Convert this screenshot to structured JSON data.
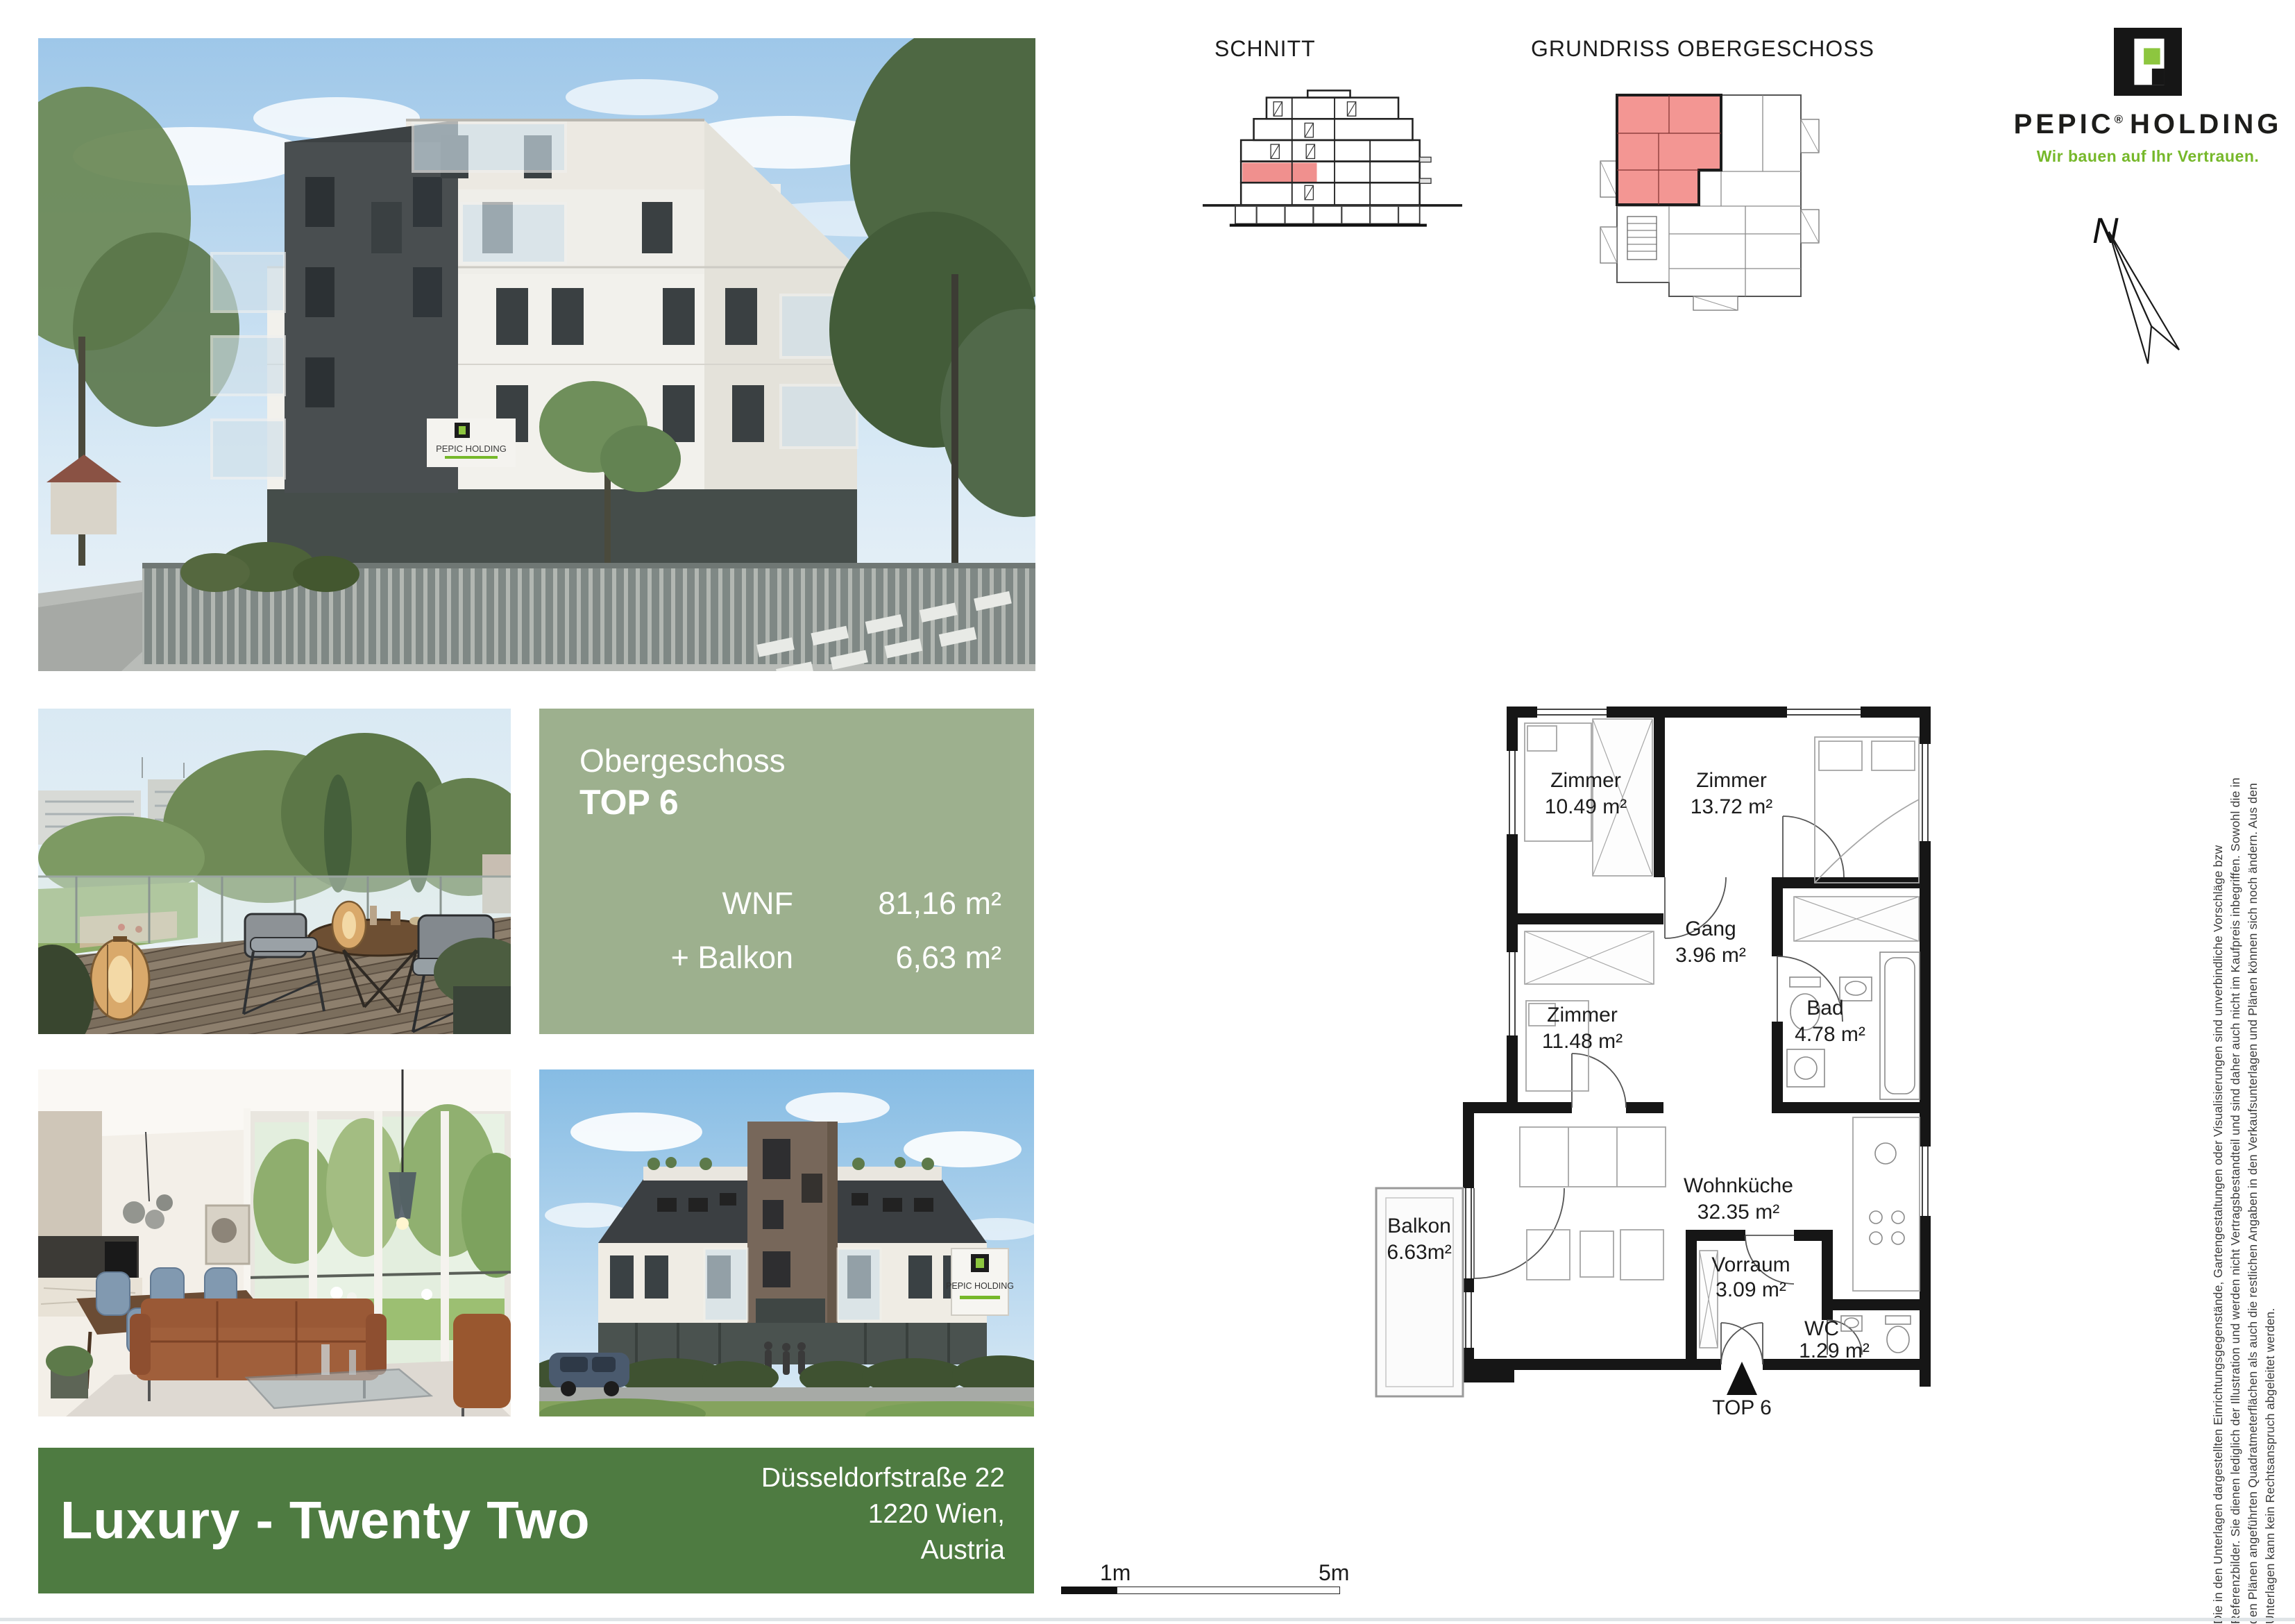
{
  "header": {
    "schnitt_label": "SCHNITT",
    "grundriss_label": "GRUNDRISS OBERGESCHOSS"
  },
  "logo": {
    "brand1": "PEPIC",
    "reg": "®",
    "brand2": "HOLDING",
    "tagline": "Wir bauen auf Ihr Vertrauen.",
    "accent_green": "#8dc63f",
    "tagline_green": "#76b82a"
  },
  "north": {
    "label": "N"
  },
  "info_box": {
    "floor": "Obergeschoss",
    "unit": "TOP 6",
    "metrics": [
      {
        "label": "WNF",
        "value": "81,16 m²"
      },
      {
        "label": "+ Balkon",
        "value": "6,63 m²"
      }
    ],
    "bg": "#9db08e"
  },
  "floor_plan": {
    "rooms": [
      {
        "name": "Zimmer",
        "area": "10.49 m²"
      },
      {
        "name": "Zimmer",
        "area": "13.72 m²"
      },
      {
        "name": "Gang",
        "area": "3.96 m²"
      },
      {
        "name": "Zimmer",
        "area": "11.48 m²"
      },
      {
        "name": "Bad",
        "area": "4.78 m²"
      },
      {
        "name": "Balkon",
        "area": "6.63m²"
      },
      {
        "name": "Wohnküche",
        "area": "32.35 m²"
      },
      {
        "name": "Vorraum",
        "area": "3.09 m²"
      },
      {
        "name": "WC",
        "area": "1.29 m²"
      }
    ],
    "entrance_label": "TOP 6",
    "highlight_color": "#f0908e"
  },
  "scale_bar": {
    "tick1": "1m",
    "tick2": "5m"
  },
  "footer": {
    "title": "Luxury - Twenty Two",
    "address_line1": "Düsseldorfstraße 22",
    "address_line2": "1220 Wien,",
    "address_line3": "Austria",
    "bg": "#4e7b41"
  },
  "photos": {
    "sign_text": "PEPIC HOLDING"
  },
  "disclaimer": {
    "lines": [
      "Die in den Unterlagen dargestellten Einrichtungsgegenstände, Gartengestaltungen oder Visualisierungen sind unverbindliche Vorschläge bzw",
      "Referenzbilder. Sie dienen lediglich der Illustration und werden nicht Vertragsbestandteil und sind daher auch nicht im Kaufpreis inbegriffen. Sowohl die in",
      "den Plänen angeführten Quadratmeterflächen als auch die restlichen Angaben in den Verkaufsunterlagen und Plänen können sich noch ändern. Aus den",
      "Unterlagen kann kein Rechtsanspruch abgeleitet werden."
    ]
  }
}
